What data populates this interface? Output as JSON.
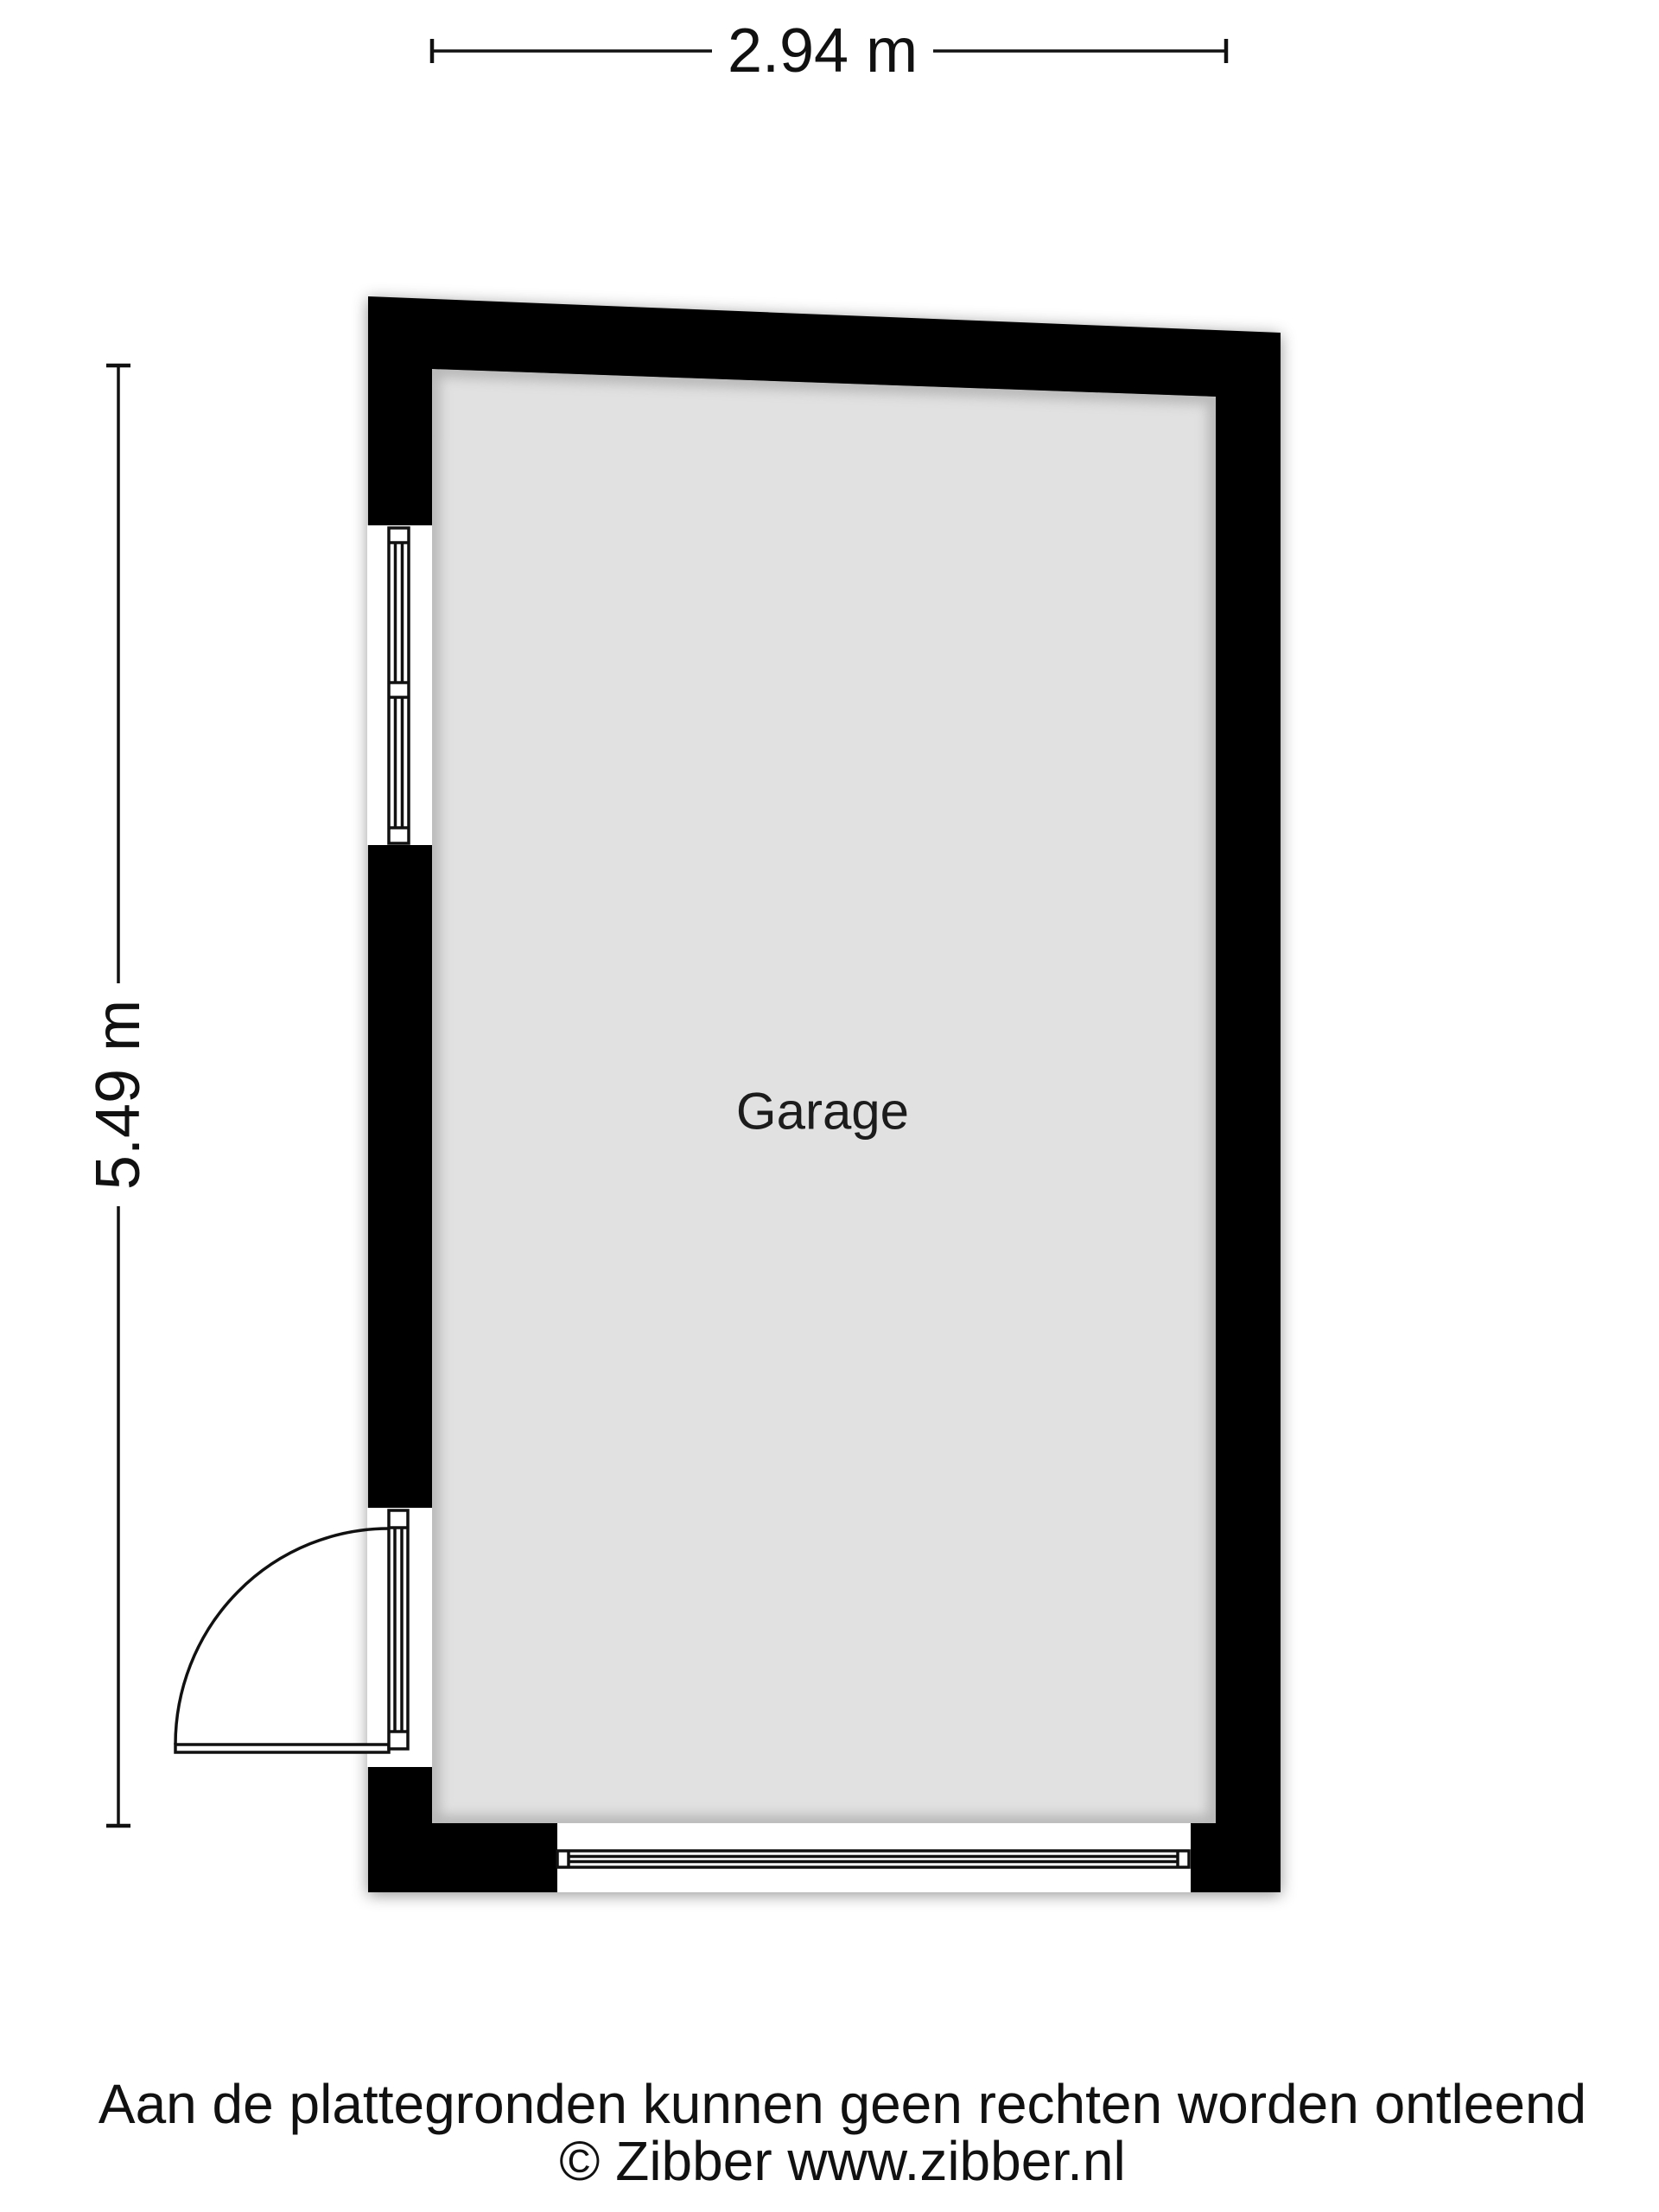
{
  "floorplan": {
    "room_label": "Garage",
    "width_dimension": "2.94 m",
    "height_dimension": "5.49 m",
    "features": {
      "left_wall_top": "window",
      "left_wall_bottom": "hinged-door-with-swing-arc",
      "bottom_wall": "garage-door"
    },
    "colors": {
      "wall": "#000000",
      "floor": "#e1e1e1",
      "symbol_line": "#111111",
      "background": "#ffffff"
    }
  },
  "footer": {
    "disclaimer": "Aan de plattegronden kunnen geen rechten worden ontleend",
    "copyright": "© Zibber www.zibber.nl"
  }
}
